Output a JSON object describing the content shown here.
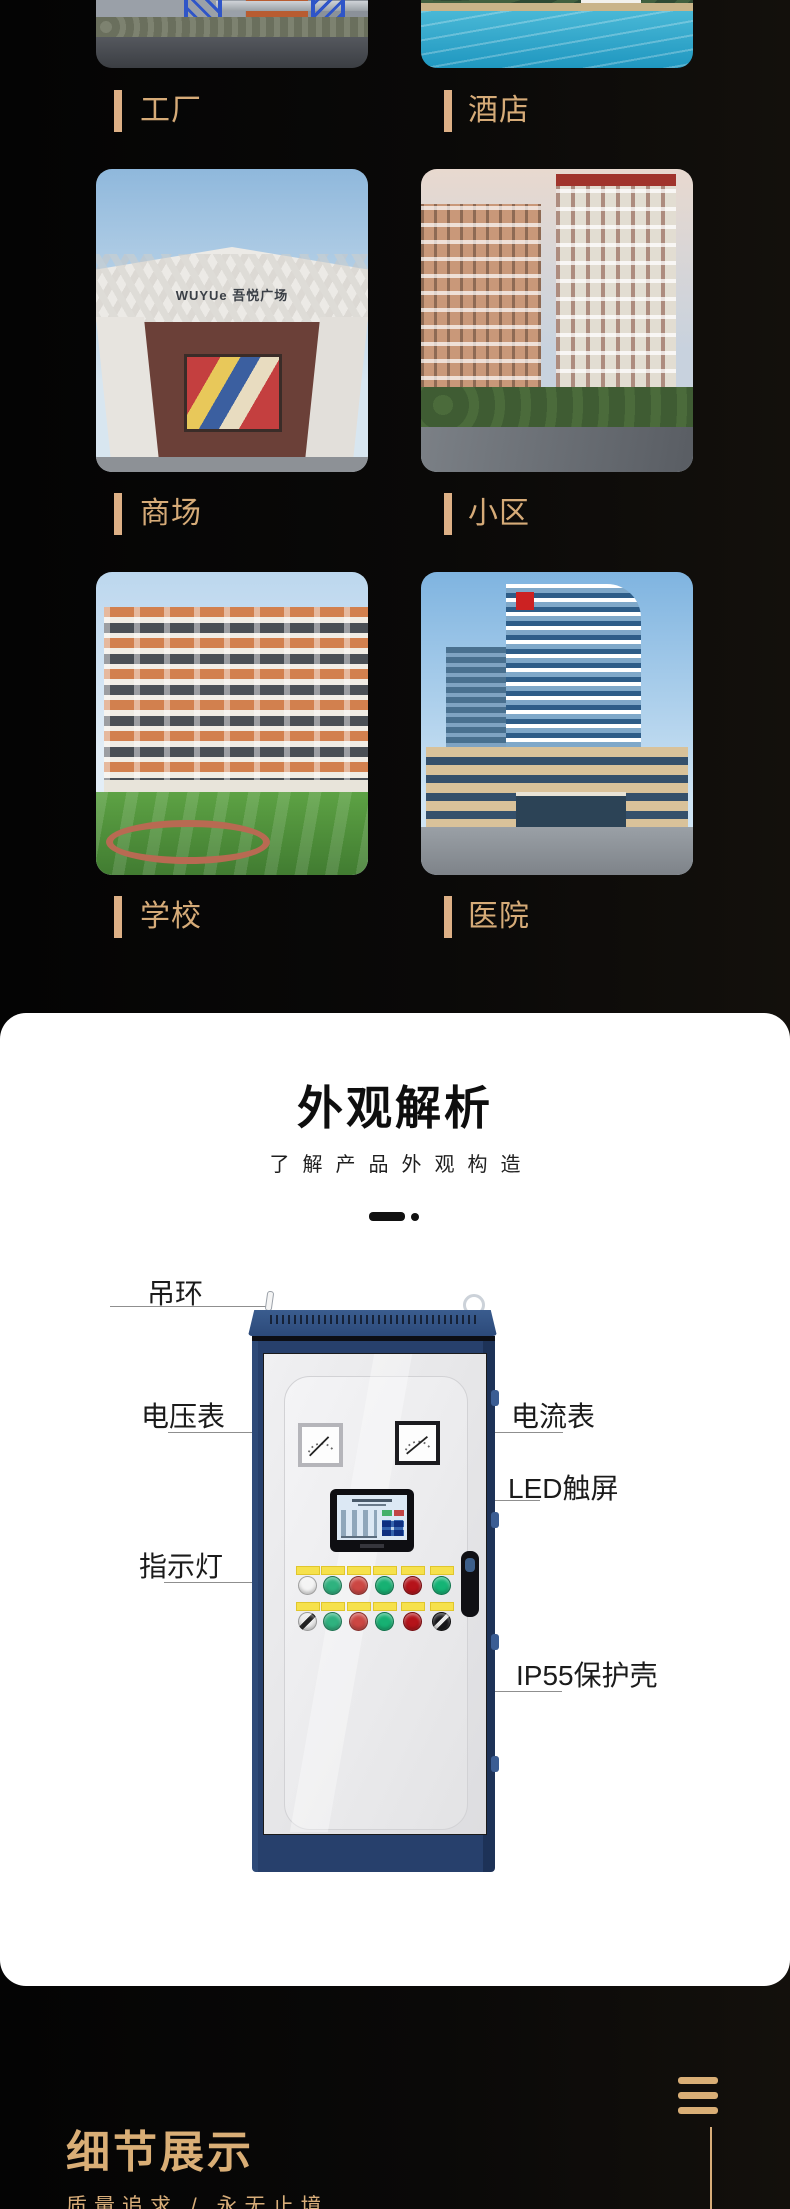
{
  "theme": {
    "accent_gold": "#d8ad79",
    "card_bg": "#ffffff",
    "dark_bg": "#070707",
    "cabinet_blue": "#27406c",
    "callout_line": "#8f8f8f"
  },
  "gallery": {
    "items": [
      {
        "label": "工厂"
      },
      {
        "label": "酒店"
      },
      {
        "label": "商场",
        "sign": "WUYUe 吾悦广场"
      },
      {
        "label": "小区"
      },
      {
        "label": "学校"
      },
      {
        "label": "医院"
      }
    ]
  },
  "appearance_section": {
    "title": "外观解析",
    "subtitle": "了解产品外观构造",
    "callouts": [
      {
        "text": "吊环"
      },
      {
        "text": "电压表"
      },
      {
        "text": "指示灯"
      },
      {
        "text": "电流表"
      },
      {
        "text": "LED触屏"
      },
      {
        "text": "IP55保护壳"
      }
    ]
  },
  "detail_section": {
    "title": "细节展示",
    "subtitle": "质量追求 / 永无止境"
  }
}
